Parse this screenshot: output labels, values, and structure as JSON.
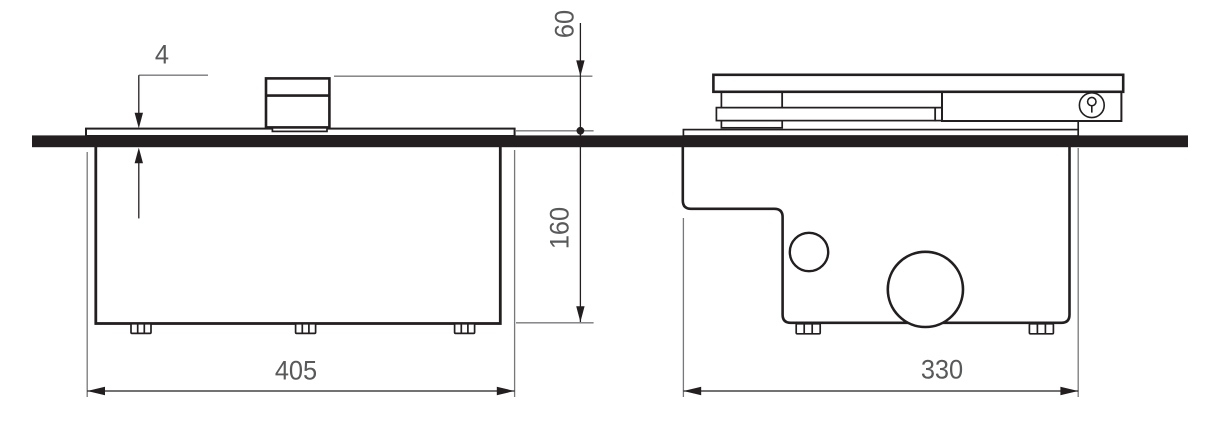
{
  "diagram": {
    "type": "technical-drawing",
    "views": {
      "front": {
        "dimensions": {
          "plate_protrusion": "4",
          "outlet_height_above_floor": "60",
          "depth_below_floor": "160",
          "width": "405"
        }
      },
      "side": {
        "dimensions": {
          "width": "330"
        }
      }
    },
    "icons": {
      "lock": "keyhole-icon"
    },
    "colors": {
      "line": "#231f20",
      "dim_text": "#58595b",
      "witness_line": "#77787b",
      "background": "#ffffff"
    }
  }
}
